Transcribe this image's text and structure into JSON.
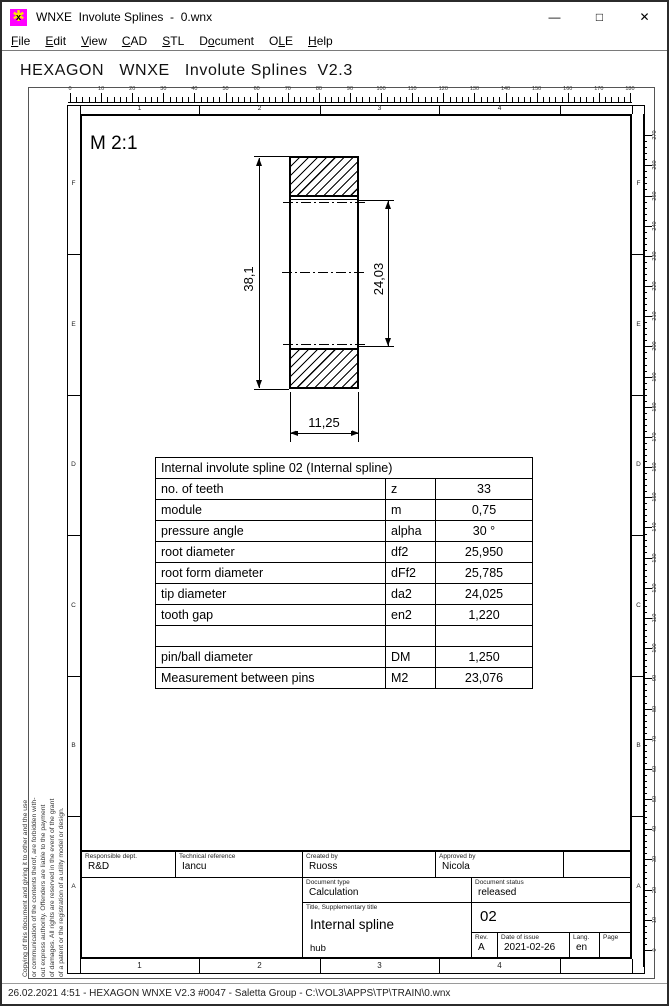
{
  "window": {
    "title": "WNXE  Involute Splines  -  0.wnx",
    "minimize": "—",
    "maximize": "□",
    "close": "✕",
    "icon_gear": "✱",
    "icon_letter": "x"
  },
  "menu": {
    "items": [
      {
        "label": "File",
        "u": 0
      },
      {
        "label": "Edit",
        "u": 0
      },
      {
        "label": "View",
        "u": 0
      },
      {
        "label": "CAD",
        "u": 0
      },
      {
        "label": "STL",
        "u": 0
      },
      {
        "label": "Document",
        "u": 1
      },
      {
        "label": "OLE",
        "u": 1
      },
      {
        "label": "Help",
        "u": 0
      }
    ]
  },
  "header": {
    "title": "HEXAGON   WNXE   Involute Splines  V2.3"
  },
  "rulers": {
    "top": {
      "min": 0,
      "max": 180,
      "label_step": 10,
      "minor_step": 2
    },
    "right": {
      "min": 0,
      "max": 270,
      "label_step": 10,
      "minor_step": 2
    }
  },
  "frame": {
    "column_labels": [
      "1",
      "2",
      "3",
      "4"
    ],
    "row_labels": [
      "F",
      "E",
      "D",
      "C",
      "B",
      "A"
    ]
  },
  "drawing": {
    "scale_label": "M 2:1",
    "dim_outer": "38,1",
    "dim_inner": "24,03",
    "dim_width": "11,25"
  },
  "table": {
    "title": "Internal involute spline 02 (Internal spline)",
    "rows": [
      {
        "name": "no. of teeth",
        "symbol": "z",
        "value": "33"
      },
      {
        "name": "module",
        "symbol": "m",
        "value": "0,75"
      },
      {
        "name": "pressure angle",
        "symbol": "alpha",
        "value": "30 °"
      },
      {
        "name": "root diameter",
        "symbol": "df2",
        "value": "25,950"
      },
      {
        "name": "root form diameter",
        "symbol": "dFf2",
        "value": "25,785"
      },
      {
        "name": "tip diameter",
        "symbol": "da2",
        "value": "24,025"
      },
      {
        "name": "tooth gap",
        "symbol": "en2",
        "value": "1,220"
      },
      {
        "name": "",
        "symbol": "",
        "value": ""
      },
      {
        "name": "pin/ball diameter",
        "symbol": "DM",
        "value": "1,250"
      },
      {
        "name": "Measurement between pins",
        "symbol": "M2",
        "value": "23,076"
      }
    ]
  },
  "titleblock": {
    "responsible_dept": {
      "label": "Responsible dept.",
      "value": "R&D"
    },
    "technical_reference": {
      "label": "Technical reference",
      "value": "Iancu"
    },
    "created_by": {
      "label": "Created by",
      "value": "Ruoss"
    },
    "approved_by": {
      "label": "Approved by",
      "value": "Nicola"
    },
    "document_type": {
      "label": "Document type",
      "value": "Calculation"
    },
    "document_status": {
      "label": "Document status",
      "value": "released"
    },
    "title_label": "Title, Supplementary title",
    "title": "Internal spline",
    "subtitle": "hub",
    "doc_number": "02",
    "rev": {
      "label": "Rev.",
      "value": "A"
    },
    "date_of_issue": {
      "label": "Date of issue",
      "value": "2021-02-26"
    },
    "lang": {
      "label": "Lang.",
      "value": "en"
    },
    "page": {
      "label": "Page",
      "value": ""
    }
  },
  "notice": {
    "lines": [
      "Copying of this document and giving it to other and the use",
      "or communication of the contents therof, are forbidden with-",
      "out express authority. Offenders are liable to the payment",
      "of damages. All rights are reserved in the event of the grant",
      "of a patent or the registration of a utility model or design."
    ]
  },
  "statusbar": {
    "text": "26.02.2021 4:51 - HEXAGON WNXE V2.3 #0047 - Saletta Group - C:\\VOL3\\APPS\\TP\\TRAIN\\0.wnx"
  }
}
